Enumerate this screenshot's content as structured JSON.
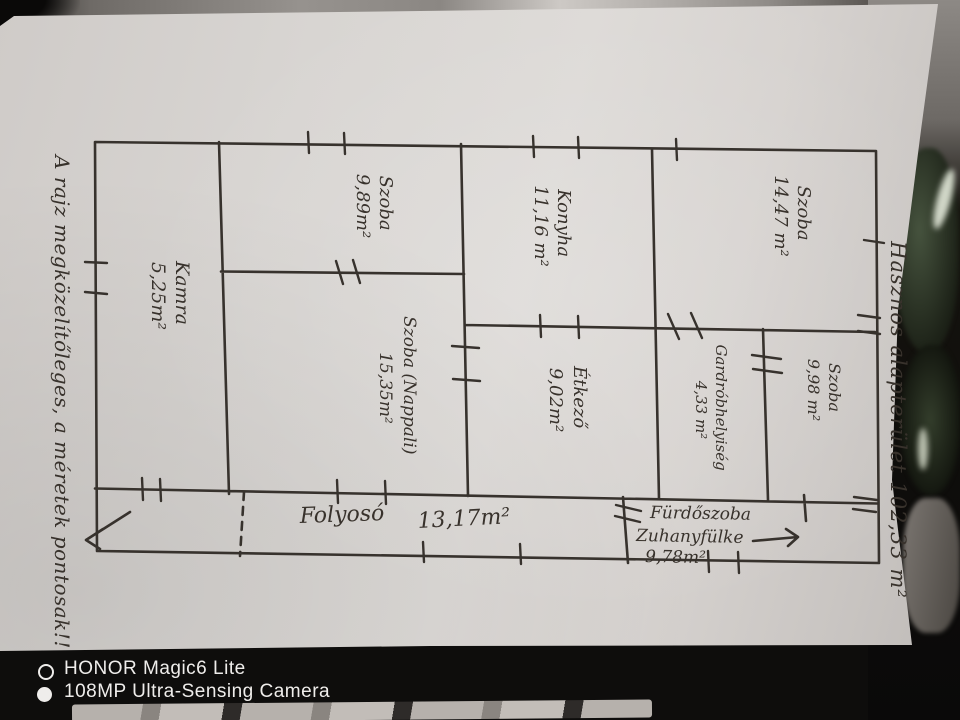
{
  "photo": {
    "watermark": {
      "device": "HONOR Magic6 Lite",
      "camera": "108MP Ultra-Sensing Camera"
    }
  },
  "floor_plan": {
    "notes": {
      "left_margin": "A rajz megközelítőleges, a méretek pontosak!!",
      "total_area": "Hasznos alapterület 102,33 m²"
    },
    "rooms": [
      {
        "name": "Szoba",
        "area": "9,89m²"
      },
      {
        "name": "Konyha",
        "area": "11,16 m²"
      },
      {
        "name": "Szoba",
        "area": "14,47 m²"
      },
      {
        "name": "Kamra",
        "area": "5,25m²"
      },
      {
        "name": "Szoba (Nappali)",
        "area": "15,35m²"
      },
      {
        "name": "Étkező",
        "area": "9,02m²"
      },
      {
        "name": "Gardróbhelyiség",
        "area": "4,33 m²"
      },
      {
        "name": "Szoba",
        "area": "9,98 m²"
      },
      {
        "name": "Folyosó",
        "area": "13,17m²"
      },
      {
        "name": "Fürdőszoba",
        "detail": "Zuhanyfülke",
        "area": "9,78m²"
      }
    ]
  }
}
